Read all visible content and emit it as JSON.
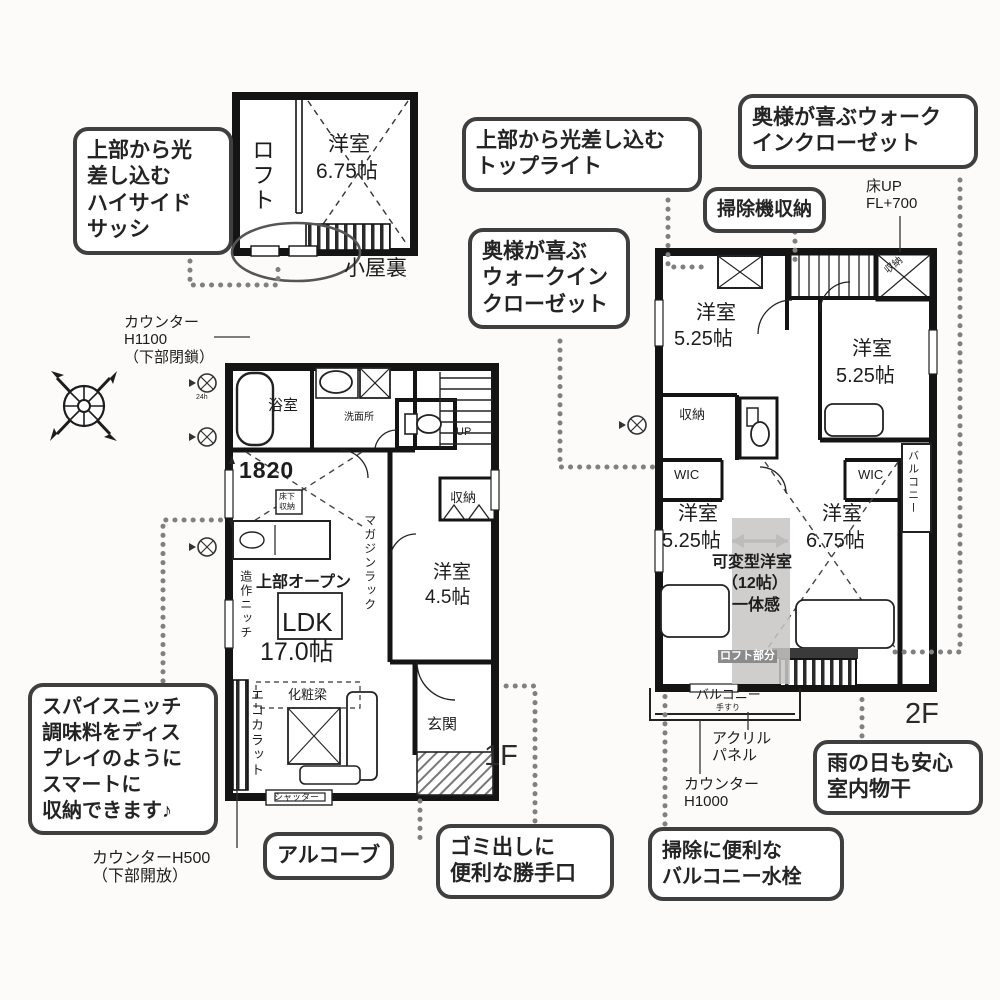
{
  "callouts": {
    "highside": {
      "lines": [
        "上部から光",
        "差し込む",
        "ハイサイド",
        "サッシ"
      ]
    },
    "toplight": {
      "lines": [
        "上部から光差し込む",
        "トップライト"
      ]
    },
    "wic_upper": {
      "lines": [
        "奥様が喜ぶウォーク",
        "インクローゼット"
      ]
    },
    "vacuum": {
      "lines": [
        "掃除機収納"
      ]
    },
    "wic_mid": {
      "lines": [
        "奥様が喜ぶ",
        "ウォークイン",
        "クローゼット"
      ]
    },
    "spice": {
      "lines": [
        "スパイスニッチ",
        "調味料をディス",
        "プレイのように",
        "スマートに",
        "収納できます♪"
      ]
    },
    "alcove": {
      "lines": [
        "アルコーブ"
      ]
    },
    "kitchen_door": {
      "lines": [
        "ゴミ出しに",
        "便利な勝手口"
      ]
    },
    "balcony_faucet": {
      "lines": [
        "掃除に便利な",
        "バルコニー水栓"
      ]
    },
    "indoor_drying": {
      "lines": [
        "雨の日も安心",
        "室内物干"
      ]
    }
  },
  "attic": {
    "side": "ロフト",
    "room": "洋室",
    "size": "6.75帖",
    "caption": "小屋裏"
  },
  "f1": {
    "floor_label": "1F",
    "bath": "浴室",
    "washroom": "洗面所",
    "underfloor_1": "床下",
    "underfloor_2": "収納",
    "stairs_up": "UP",
    "closet": "収納",
    "dim": "1820",
    "vent": "24h",
    "open_above": "上部オープン",
    "ldk": "LDK",
    "ldk_size": "17.0帖",
    "beam": "化粧梁",
    "eco_tile": "エコカラット",
    "niche": "造作ニッチ",
    "magazine": "マガジンラック",
    "room": "洋室",
    "room_size": "4.5帖",
    "entrance": "玄関",
    "shutter": "シャッター"
  },
  "f2": {
    "floor_label": "2F",
    "room_nw": "洋室",
    "size_nw": "5.25帖",
    "room_ne": "洋室",
    "size_ne": "5.25帖",
    "room_sw": "洋室",
    "size_sw": "5.25帖",
    "room_se": "洋室",
    "size_se": "6.75帖",
    "closet_w": "収納",
    "closet_ne": "収納",
    "wic_l": "WIC",
    "wic_r": "WIC",
    "flex_1": "可変型洋室",
    "flex_2": "（12帖）",
    "flex_3": "一体感",
    "loft_part": "ロフト部分",
    "balcony_s": "バルコニー",
    "rail": "手すり",
    "balcony_e": "バルコニー"
  },
  "notes": {
    "floor_up_1": "床UP",
    "floor_up_2": "FL+700",
    "counter1100_1": "カウンター",
    "counter1100_2": "H1100",
    "counter1100_3": "（下部閉鎖）",
    "counter500_1": "カウンターH500",
    "counter500_2": "（下部開放）",
    "counter1000_1": "カウンター",
    "counter1000_2": "H1000",
    "acrylic_1": "アクリル",
    "acrylic_2": "パネル"
  }
}
